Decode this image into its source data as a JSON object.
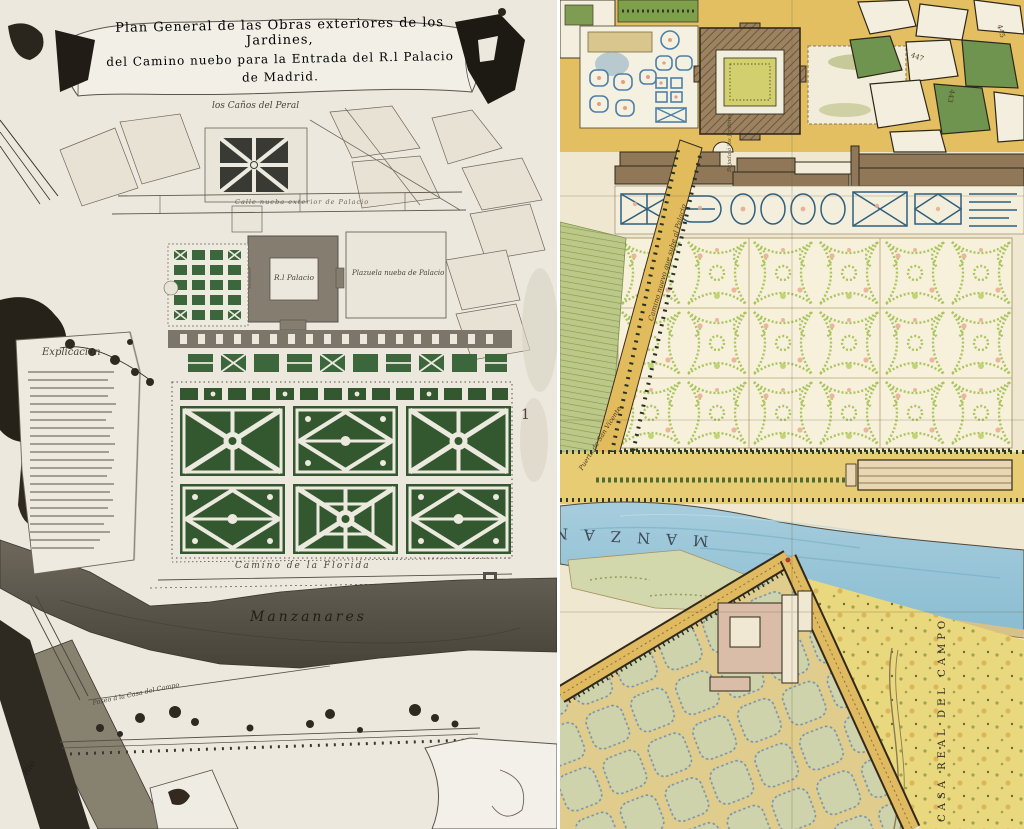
{
  "left_map": {
    "title_line1": "Plan General de las Obras exteriores de los Jardines,",
    "title_line2": "del Camino nuebo para la Entrada del R.l Palacio",
    "title_line3": "de Madrid.",
    "labels": {
      "canos_del_peral": "los Caños del Peral",
      "calle_nueva": "Calle nueba exterior de Palacio",
      "palacio": "R.l Palacio",
      "plazuela": "Plazuela nueba de Palacio",
      "explicacion": "Explicacion",
      "camino_florida": "Camino de la Florida",
      "manzanares": "Manzanares",
      "paseo_casa_campo": "Paseo á la Casa del Campo",
      "rio": "Rio",
      "marker_1": "1"
    }
  },
  "right_map": {
    "labels": {
      "camino_nuevo": "Camino nuevo que sube al Palacio",
      "puerta_san_vicente": "Puerta de San Vicente",
      "bajada_jardines": "Bajada á los Jardines",
      "manzanares": "MANZANARES",
      "casa_real_del_campo": "CASA REAL DEL CAMPO",
      "block_443": "443",
      "block_445": "445",
      "block_447": "447"
    }
  },
  "colors": {
    "left_paper": "#ece8dd",
    "left_parterre_green": "#33582f",
    "left_ink": "#55504a",
    "right_paper": "#efe7cf",
    "street_yellow": "#e3bf62",
    "river_blue": "#a6cddd",
    "broderie_green": "#aac45e",
    "palace_brown": "#9b8261",
    "hedge_blue": "#4f7fa8"
  }
}
